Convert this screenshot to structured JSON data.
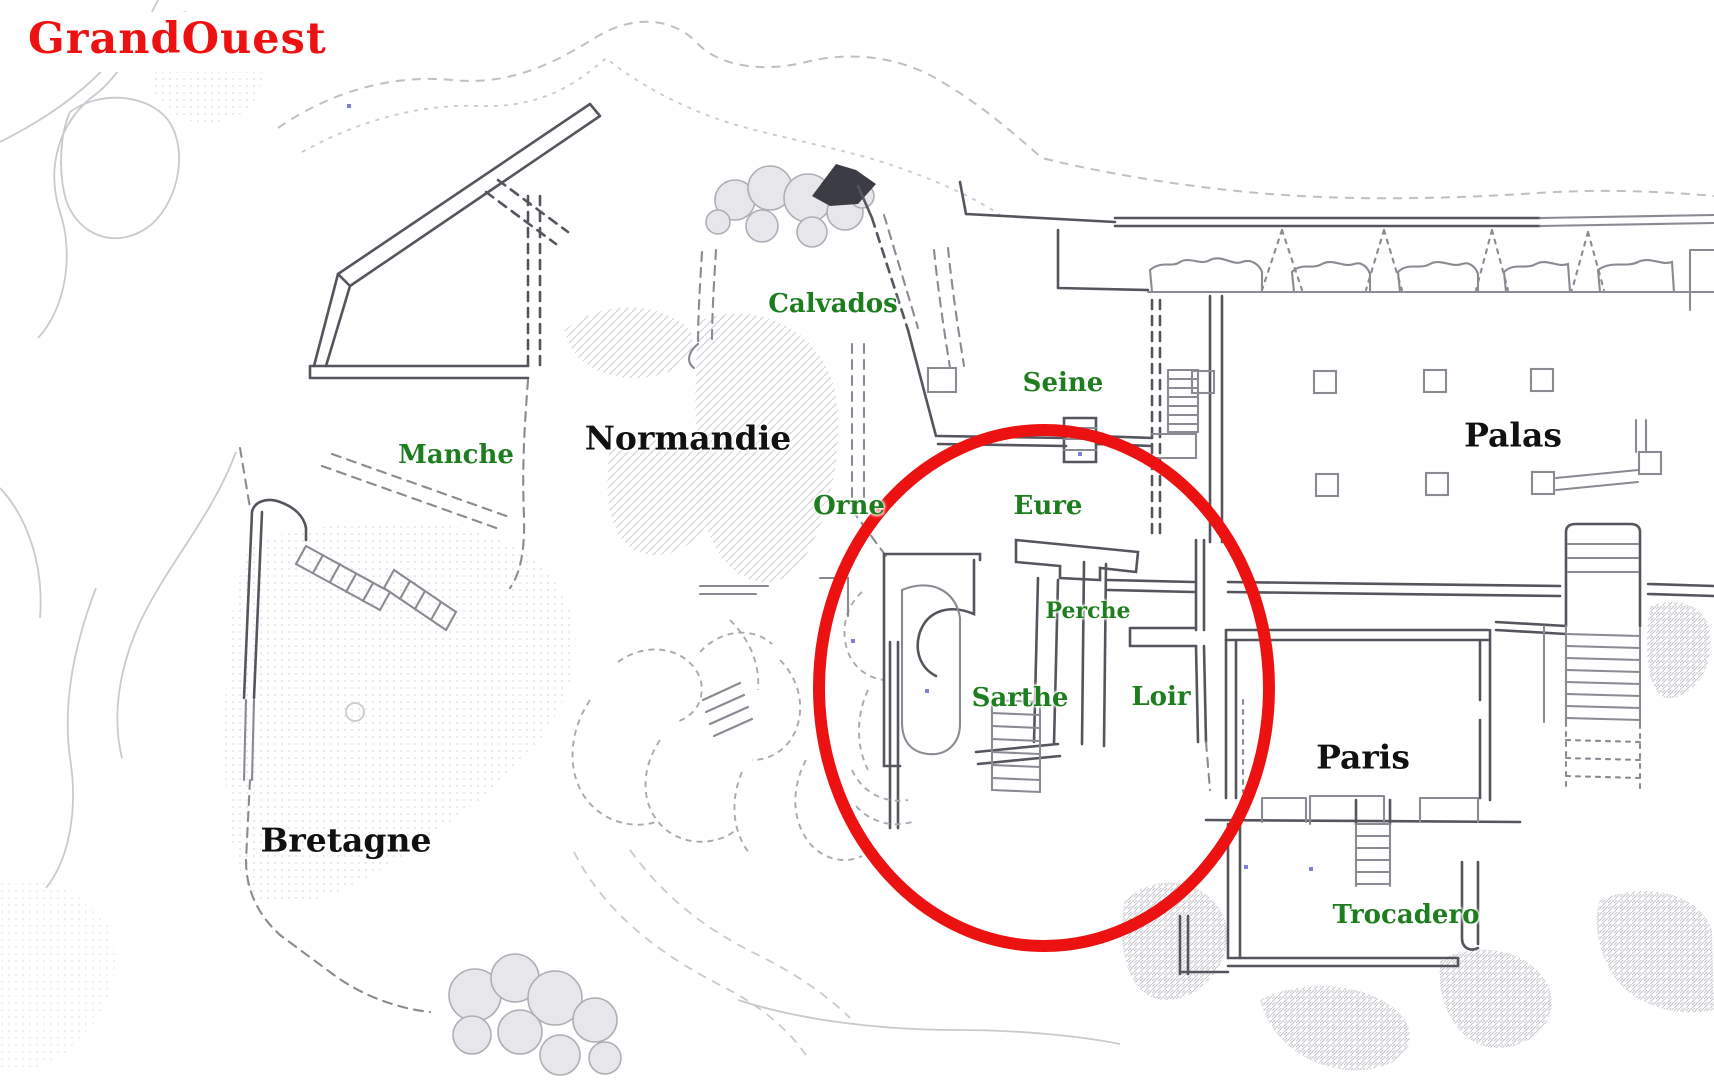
{
  "page": {
    "background": "#ffffff",
    "kind": "architectural site plan with region annotations"
  },
  "colors": {
    "title_red": "#ee1111",
    "ellipse_red": "#ec1212",
    "district_black": "#111111",
    "area_green": "#1e7d1e",
    "wall_gray": "#55555e",
    "terrain_gray": "#bfbfc6"
  },
  "map": {
    "title": {
      "text": "GrandOuest",
      "color": "#ee1111"
    },
    "highlight": {
      "shape": "ellipse",
      "cx": 1044,
      "cy": 688,
      "rx": 225,
      "ry": 258,
      "stroke_width": 12,
      "color": "#ec1212",
      "encircles": [
        "Eure",
        "Perche",
        "Sarthe",
        "Loir"
      ]
    },
    "labels": [
      {
        "id": "normandie",
        "text": "Normandie",
        "kind": "district",
        "color": "#111111",
        "x": 688,
        "y": 438,
        "size": 33
      },
      {
        "id": "bretagne",
        "text": "Bretagne",
        "kind": "district",
        "color": "#111111",
        "x": 346,
        "y": 840,
        "size": 33
      },
      {
        "id": "palas",
        "text": "Palas",
        "kind": "district",
        "color": "#111111",
        "x": 1513,
        "y": 435,
        "size": 33
      },
      {
        "id": "paris",
        "text": "Paris",
        "kind": "district",
        "color": "#111111",
        "x": 1363,
        "y": 757,
        "size": 33
      },
      {
        "id": "manche",
        "text": "Manche",
        "kind": "area",
        "color": "#1e7d1e",
        "x": 456,
        "y": 455,
        "size": 26
      },
      {
        "id": "calvados",
        "text": "Calvados",
        "kind": "area",
        "color": "#1e7d1e",
        "x": 833,
        "y": 304,
        "size": 26
      },
      {
        "id": "seine",
        "text": "Seine",
        "kind": "area",
        "color": "#1e7d1e",
        "x": 1063,
        "y": 383,
        "size": 26
      },
      {
        "id": "orne",
        "text": "Orne",
        "kind": "area",
        "color": "#1e7d1e",
        "x": 849,
        "y": 506,
        "size": 26
      },
      {
        "id": "eure",
        "text": "Eure",
        "kind": "area",
        "color": "#1e7d1e",
        "x": 1048,
        "y": 506,
        "size": 26
      },
      {
        "id": "perche",
        "text": "Perche",
        "kind": "area",
        "color": "#1e7d1e",
        "x": 1088,
        "y": 611,
        "size": 22
      },
      {
        "id": "sarthe",
        "text": "Sarthe",
        "kind": "area",
        "color": "#1e7d1e",
        "x": 1020,
        "y": 698,
        "size": 26
      },
      {
        "id": "loir",
        "text": "Loir",
        "kind": "area",
        "color": "#1e7d1e",
        "x": 1161,
        "y": 697,
        "size": 26
      },
      {
        "id": "trocadero",
        "text": "Trocadero",
        "kind": "area",
        "color": "#1e7d1e",
        "x": 1406,
        "y": 915,
        "size": 26
      }
    ]
  }
}
